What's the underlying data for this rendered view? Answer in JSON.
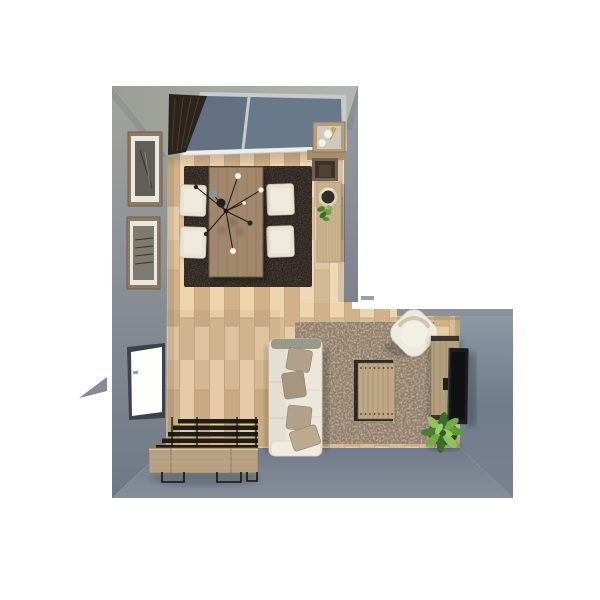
{
  "scene": {
    "view": "top-down-3d-render",
    "rooms": [
      {
        "name": "dining-area"
      },
      {
        "name": "hallway"
      },
      {
        "name": "living-area"
      }
    ],
    "items": [
      {
        "name": "dining-table"
      },
      {
        "name": "dining-chair",
        "count": 4
      },
      {
        "name": "spider-chandelier"
      },
      {
        "name": "dining-rug"
      },
      {
        "name": "wall-picture",
        "count": 2
      },
      {
        "name": "top-wall-window"
      },
      {
        "name": "window-blind"
      },
      {
        "name": "wall-shelf-with-lamp"
      },
      {
        "name": "console-cabinet-with-bowl-and-plant"
      },
      {
        "name": "side-window"
      },
      {
        "name": "storage-bench"
      },
      {
        "name": "sofa"
      },
      {
        "name": "sofa-pillow",
        "count": 4
      },
      {
        "name": "armchair"
      },
      {
        "name": "coffee-table"
      },
      {
        "name": "living-rug"
      },
      {
        "name": "tv-stand"
      },
      {
        "name": "tv"
      },
      {
        "name": "floor-plant"
      }
    ]
  },
  "colors": {
    "background": "#ffffff",
    "wall_top_left": "#9a9c96",
    "wall_top_right": "#b4b6b0",
    "wall_left_top": "#a2a39c",
    "wall_left_bottom": "#6f7885",
    "wall_dining_right_top": "#989ba0",
    "wall_dining_right_bottom": "#7d838c",
    "wall_living_right_top": "#8f9aa7",
    "wall_living_right_bottom": "#717c8b",
    "wall_bottom_top": "#727b8a",
    "wall_bottom_bottom": "#858e9a",
    "wall_ext_strip": "#8b919b",
    "plank_light": "#eed4ad",
    "plank_mid": "#e0c49c",
    "plank_dark": "#d0b189",
    "rug_dining": "#2c2520",
    "rug_living": "#8d7965",
    "dining_table": "#a1886d",
    "chair": "#e8e3d2",
    "chandelier": "#1d1a16",
    "sofa": "#ebe7da",
    "sofa_pillow": "#b3a08a",
    "armchair": "#eeeade",
    "coffee_table_top": "#bfa888",
    "coffee_table_frame": "#2f2a24",
    "tv_stand": "#b39e7d",
    "tv": "#1b1d21",
    "plant_leaf": "#5f9a38",
    "plant_leaf_dark": "#3c6b2b",
    "bench_slats": "#221c16",
    "bench_front": "#b79f81",
    "shelf_wood": "#b69c79",
    "shelf_dark": "#3a332d",
    "cabinet": "#ccb48f",
    "window_glass": "#627082",
    "window_glass_light": "#6d7c8e",
    "window_frame": "#c7cbcb",
    "side_window_glass": "#fdfdfc",
    "picture_frame": "#8e7a60",
    "picture_mat": "#e9e7e0",
    "picture_art": "#615e58",
    "lamp_brass": "#c9a84c",
    "bowl": "#dbcfb8"
  }
}
